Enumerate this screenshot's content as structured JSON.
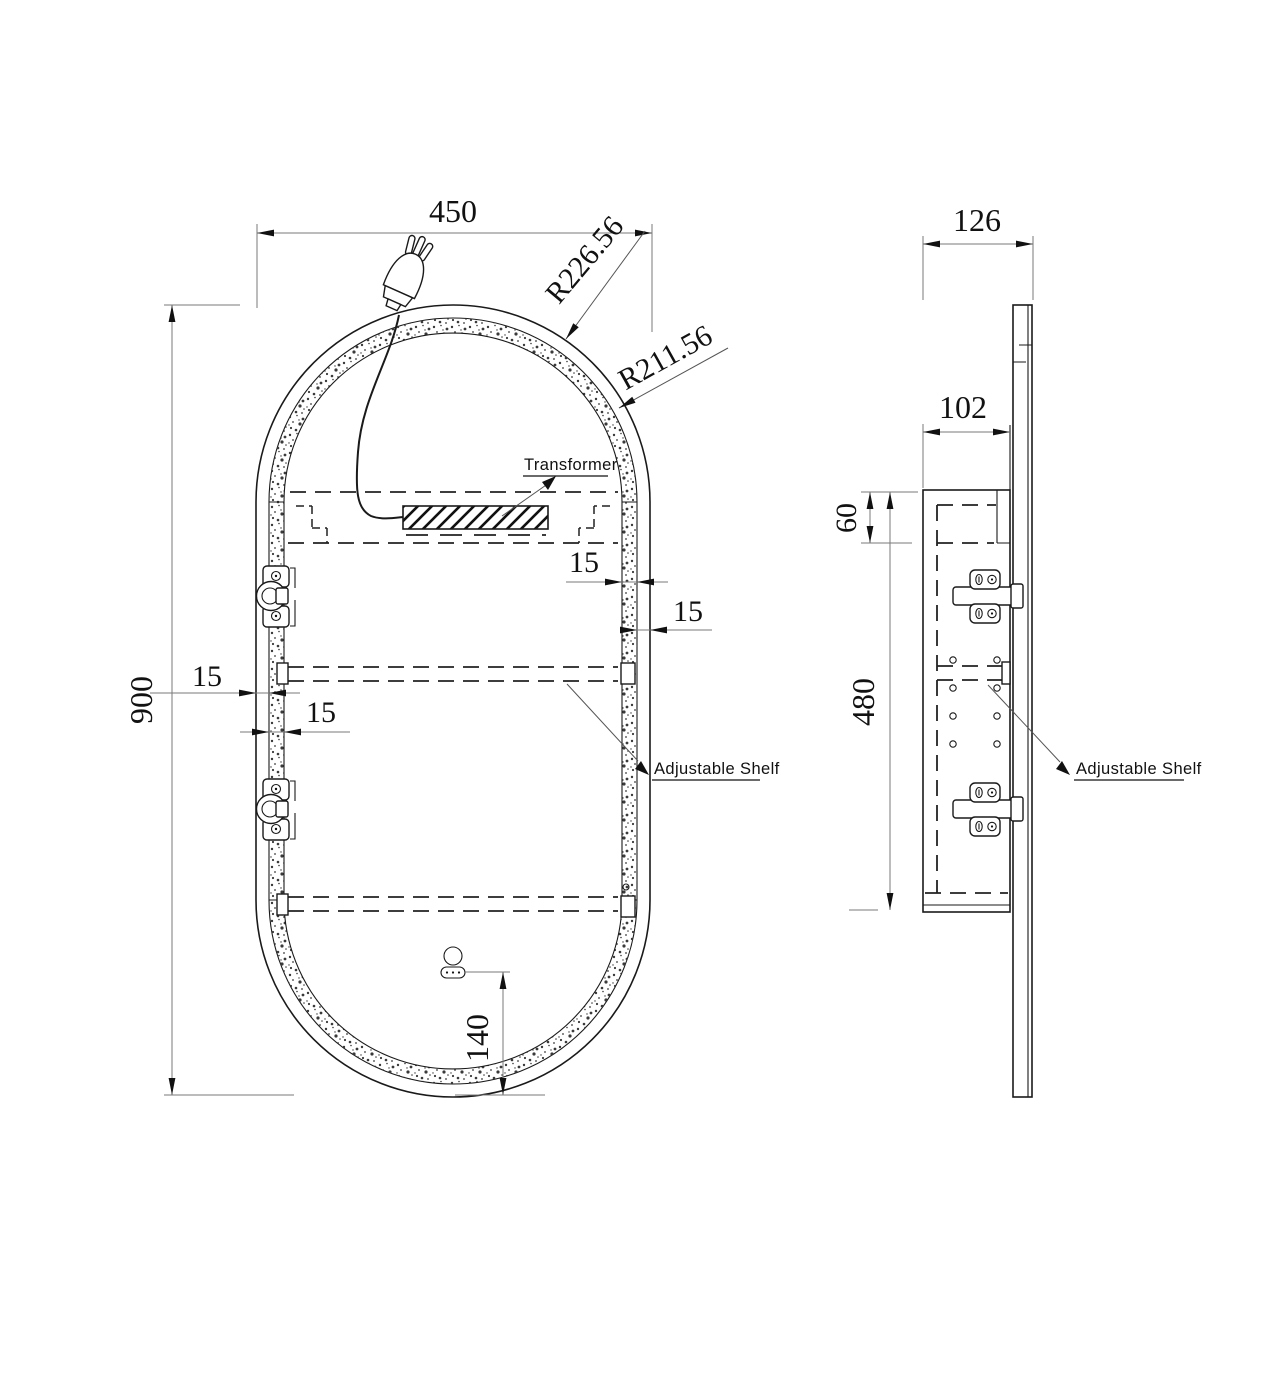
{
  "drawing": {
    "front_view": {
      "width_dim": "450",
      "height_dim": "900",
      "outer_radius_dim": "R226.56",
      "inner_radius_dim": "R211.56",
      "frame_right_strip_dim": "15",
      "frame_right_gap_dim": "15",
      "frame_left_gap_dim": "15",
      "frame_left_strip_dim": "15",
      "sensor_bottom_offset_dim": "140",
      "transformer_label": "Transformer",
      "adjustable_shelf_label": "Adjustable Shelf"
    },
    "side_view": {
      "overall_depth_dim": "126",
      "cabinet_depth_dim": "102",
      "top_compartment_height_dim": "60",
      "cabinet_height_dim": "480",
      "adjustable_shelf_label": "Adjustable Shelf"
    }
  }
}
